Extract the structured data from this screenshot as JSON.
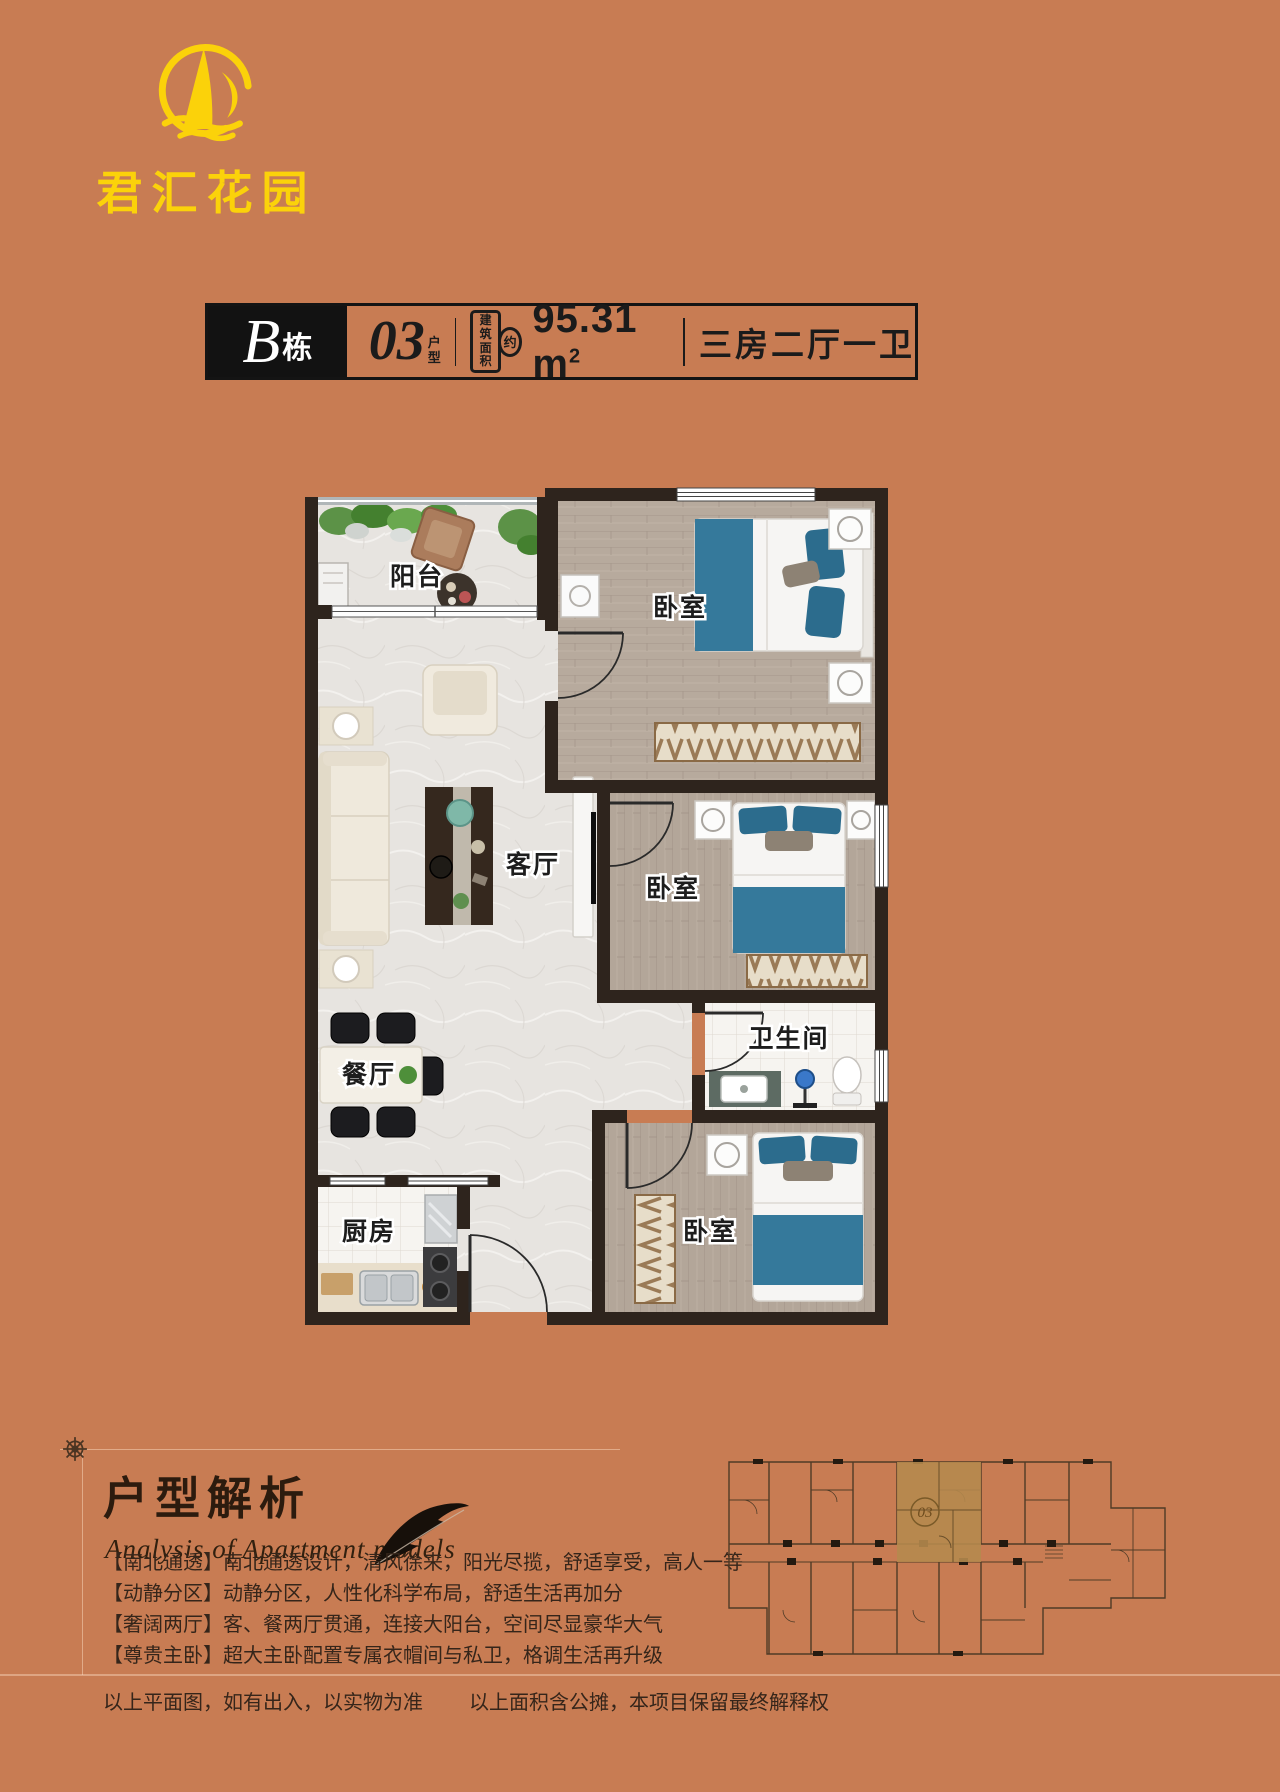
{
  "logo": {
    "name": "君汇花园",
    "accent_color": "#fbd20a"
  },
  "title_bar": {
    "building": "B",
    "building_suffix": "栋",
    "unit": "03",
    "unit_suffix_line1": "户",
    "unit_suffix_line2": "型",
    "area_label_line1": "建筑",
    "area_label_line2": "面积",
    "area_approx": "约",
    "area_value": "95.31 m",
    "area_unit_sup": "2",
    "layout": "三房二厅一卫"
  },
  "floorplan": {
    "rooms": {
      "balcony": "阳台",
      "bedroom1": "卧室",
      "living": "客厅",
      "bedroom2": "卧室",
      "dining": "餐厅",
      "bathroom": "卫生间",
      "kitchen": "厨房",
      "bedroom3": "卧室"
    },
    "colors": {
      "wall": "#2e241d",
      "wood_floor": "#b7aa9d",
      "marble_floor": "#e7e4e0",
      "tile_floor": "#f6f4f0",
      "bed_blue": "#35799b"
    }
  },
  "analysis": {
    "title": "户型解析",
    "subtitle": "Analysis of Apartment models",
    "bullets": [
      "【南北通透】南北通透设计，清风徐来，阳光尽揽，舒适享受，高人一等",
      "【动静分区】动静分区，人性化科学布局，舒适生活再加分",
      "【奢阔两厅】客、餐两厅贯通，连接大阳台，空间尽显豪华大气",
      "【尊贵主卧】超大主卧配置专属衣帽间与私卫，格调生活再升级"
    ]
  },
  "minimap": {
    "unit_label": "03"
  },
  "disclaimer": {
    "left": "以上平面图，如有出入，以实物为准",
    "right": "以上面积含公摊，本项目保留最终解释权"
  }
}
